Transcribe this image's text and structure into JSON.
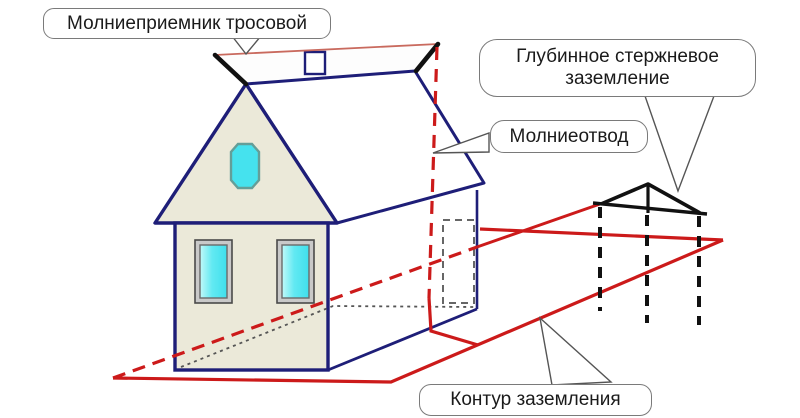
{
  "callouts": {
    "cable_receiver": {
      "text": "Молниеприемник тросовой"
    },
    "deep_rod": {
      "line1": "Глубинное стержневое",
      "line2": "заземление"
    },
    "down_conductor": {
      "text": "Молниеотвод"
    },
    "ground_loop": {
      "text": "Контур заземления"
    }
  },
  "colors": {
    "house_outline_navy": "#1e1e78",
    "wall_beige": "#ebe9d9",
    "window_cyan": "#45e2ee",
    "conductor_red": "#cc1a1a",
    "ridge_cable_salmon": "#c96a5e",
    "rod_structure_black": "#111111",
    "hidden_edge_gray": "#555555",
    "callout_border_gray": "#7a7a7a",
    "callout_text": "#1a1a1a",
    "background": "#ffffff"
  }
}
